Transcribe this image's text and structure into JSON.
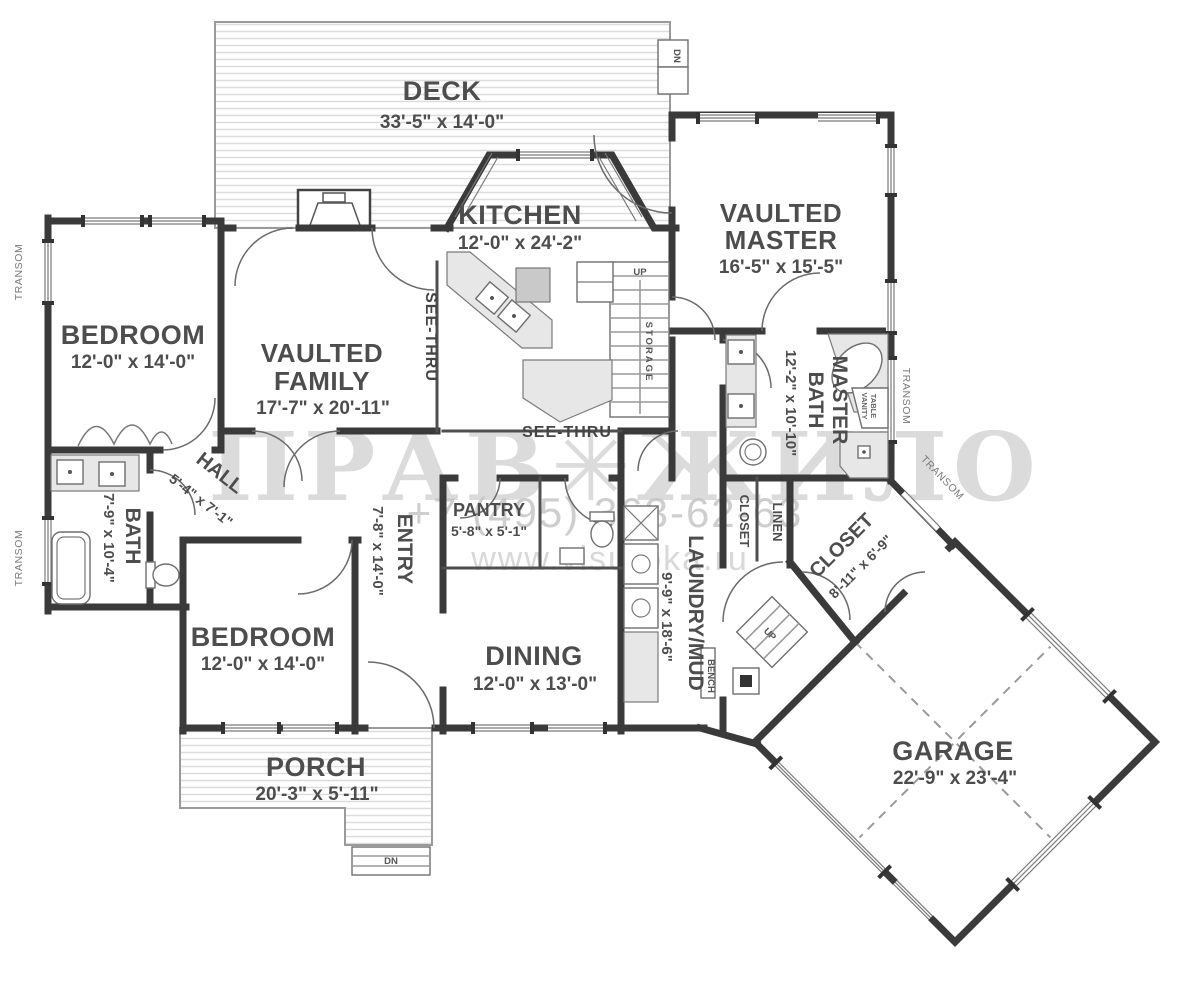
{
  "watermark": {
    "logo": "ПРАВ✳ЖИЛО",
    "phone": "+7 (495) 363-62-63",
    "site": "www.visuroka.ru"
  },
  "rooms": {
    "deck": {
      "name": "DECK",
      "dims": "33'-5\" x 14'-0\""
    },
    "kitchen": {
      "name": "KITCHEN",
      "dims": "12'-0\" x 24'-2\""
    },
    "master": {
      "line1": "VAULTED",
      "line2": "MASTER",
      "dims": "16'-5\" x 15'-5\""
    },
    "bedroom1": {
      "name": "BEDROOM",
      "dims": "12'-0\" x 14'-0\""
    },
    "family": {
      "line1": "VAULTED",
      "line2": "FAMILY",
      "dims": "17'-7\" x 20'-11\""
    },
    "hall": {
      "name": "HALL",
      "dims": "5'-4\" x 7'-1\""
    },
    "bath": {
      "name": "BATH",
      "dims": "7'-9\" x 10'-4\""
    },
    "entry": {
      "name": "ENTRY",
      "dims": "7'-8\" x 14'-0\""
    },
    "pantry": {
      "name": "PANTRY",
      "dims": "5'-8\" x 5'-1\""
    },
    "master_bath": {
      "line1": "MASTER",
      "line2": "BATH",
      "dims": "12'-2\" x 10'-10\""
    },
    "walkin_closet": {
      "name": "CLOSET",
      "dims": "8'-11\" x 6'-9\""
    },
    "bedroom2": {
      "name": "BEDROOM",
      "dims": "12'-0\" x 14'-0\""
    },
    "dining": {
      "name": "DINING",
      "dims": "12'-0\" x 13'-0\""
    },
    "laundry": {
      "name": "LAUNDRY/MUD",
      "dims": "9'-9\" x 18'-6\""
    },
    "porch": {
      "name": "PORCH",
      "dims": "20'-3\" x 5'-11\""
    },
    "garage": {
      "name": "GARAGE",
      "dims": "22'-9\" x 23'-4\""
    }
  },
  "annotations": {
    "see_thru": "SEE-THRU",
    "closet": "CLOSET",
    "linen": "LINEN",
    "bench": "BENCH",
    "storage": "STORAGE",
    "up": "UP",
    "dn": "DN",
    "transom": "TRANSOM",
    "vanity_line1": "VANITY",
    "vanity_line2": "TABLE"
  }
}
